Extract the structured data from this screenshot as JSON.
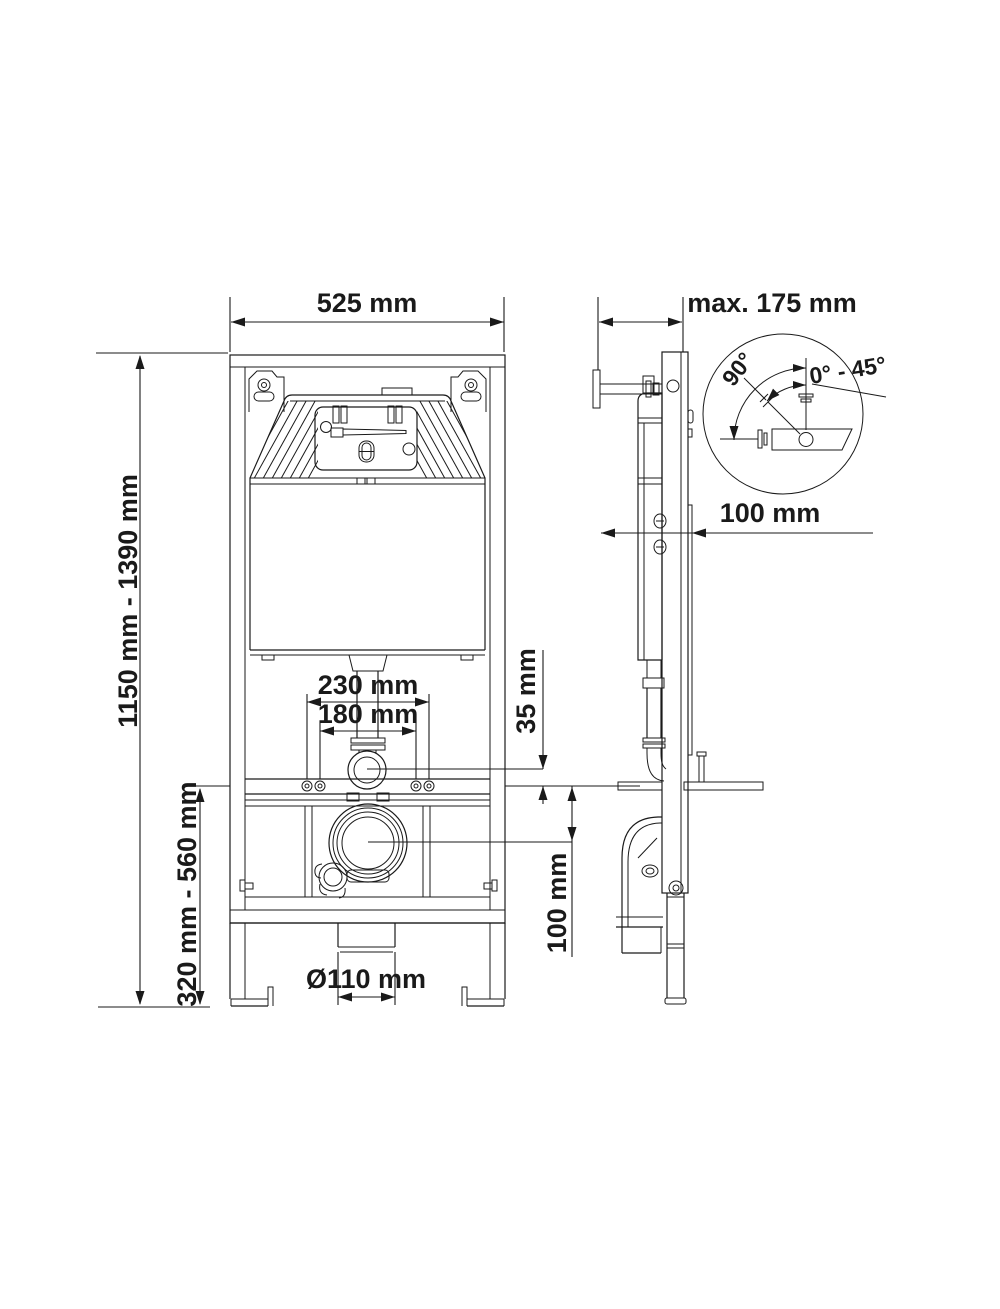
{
  "page": {
    "background": "#ffffff",
    "line_color": "#1a1a1a"
  },
  "front_view": {
    "labels": {
      "width": "525 mm",
      "height_range": "1150 mm - 1390 mm",
      "bowl_height_range": "320 mm - 560 mm",
      "flush_pipe_outer": "230 mm",
      "flush_pipe_inner": "180 mm",
      "flush_offset": "35 mm",
      "outlet_center": "100 mm",
      "outlet_diameter": "Ø110 mm"
    }
  },
  "side_view": {
    "labels": {
      "depth_max": "max. 175 mm",
      "wall_offset": "100 mm"
    }
  },
  "angle_detail": {
    "labels": {
      "sweep": "90°",
      "range": "0° - 45°"
    }
  }
}
